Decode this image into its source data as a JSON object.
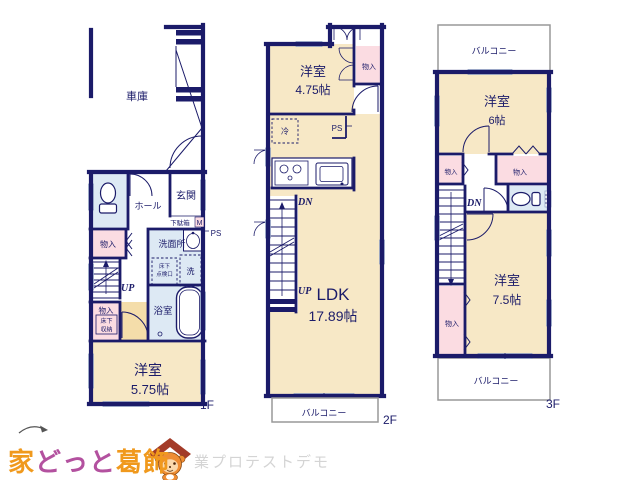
{
  "colors": {
    "wall_navy": "#1b1b69",
    "room_cream": "#f7e8c6",
    "closet_pink": "#fbdce2",
    "wet_area_blue": "#dde9f4",
    "door_tan": "#f4ddaa",
    "balcony_gray": "#999999",
    "logo_orange": "#f0991d",
    "logo_purple": "#b3519f",
    "watermark_gray": "#d4d4d4"
  },
  "floor1": {
    "floor_label": "1F",
    "garage": "車庫",
    "hall": "ホール",
    "entrance": "玄関",
    "shoe_box": "下駄箱",
    "shoe_box_tag": "M",
    "washroom": "洗面所",
    "underfloor_hatch_line1": "床下",
    "underfloor_hatch_line2": "点検口",
    "washer": "洗",
    "ps": "PS",
    "closet_a": "物入",
    "up": "UP",
    "closet_b": "物入",
    "underfloor_storage_line1": "床下",
    "underfloor_storage_line2": "収納",
    "bathroom": "浴室",
    "bedroom": "洋室",
    "bedroom_size": "5.75帖"
  },
  "floor2": {
    "floor_label": "2F",
    "bedroom": "洋室",
    "bedroom_size": "4.75帖",
    "closet": "物入",
    "fridge": "冷",
    "ps": "PS",
    "dn": "DN",
    "up": "UP",
    "ldk": "LDK",
    "ldk_size": "17.89帖",
    "balcony": "バルコニー"
  },
  "floor3": {
    "floor_label": "3F",
    "balcony_top": "バルコニー",
    "bedroom_a": "洋室",
    "bedroom_a_size": "6帖",
    "closet_a": "物入",
    "closet_b": "物入",
    "dn": "DN",
    "bedroom_b": "洋室",
    "bedroom_b_size": "7.5帖",
    "closet_c": "物入",
    "balcony_bottom": "バルコニー"
  },
  "branding": {
    "logo_part1": "家",
    "logo_part2": "どっと",
    "logo_part3": "葛飾",
    "watermark": "業プロテストデモ"
  }
}
